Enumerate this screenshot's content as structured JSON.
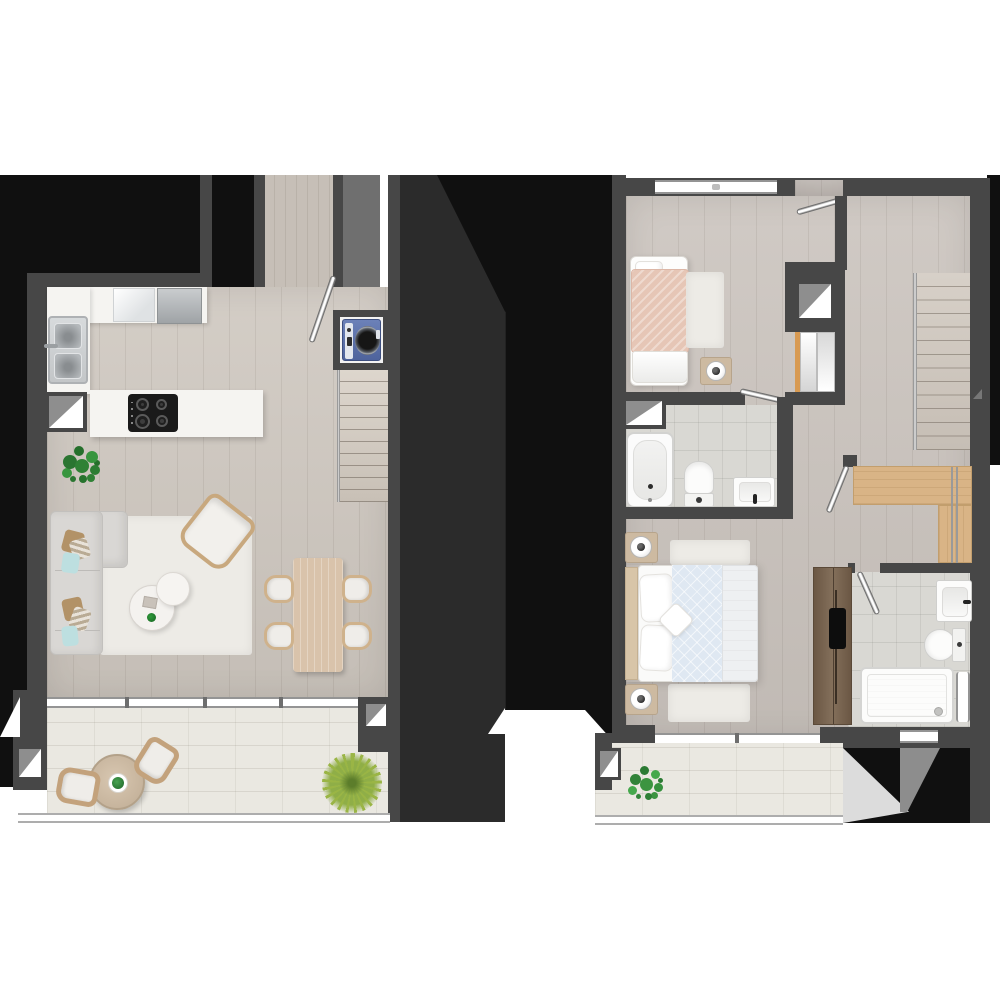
{
  "palette": {
    "bg": "#ffffff",
    "wall": "#474747",
    "black": "#101010",
    "charcoal": "#2b2b2b",
    "midGray": "#6f6f6f",
    "shaftGray": "#8e8e8e",
    "woodA": "#cfc8c0",
    "woodB": "#cbc4be",
    "corridorWood": "#c6bfb7",
    "tile": "#eae8e1",
    "bathTile": "#d9d8d3",
    "counter": "#f5f4f1",
    "cooktop": "#1a1a1a",
    "sofa": "#d9d7d4",
    "pillowTan": "#b29267",
    "pillowTeal": "#bddfe0",
    "rug": "#edebe6",
    "tableWood": "#d9c3ab",
    "chairWood": "#cfb28c",
    "blush": "#e6c6b6",
    "duvet": "#dfe8f2",
    "blanket": "#eef0f2",
    "headboard": "#d8c5a8",
    "nightstand": "#cdbaa1",
    "walkinWood": "#d9b486",
    "tvUnit": "#76614d",
    "washerBlue": "#5d74ad",
    "plantDark": "#2f8135",
    "plantPalm": "#9ab545",
    "plantBalcony": "#3c9440",
    "windowFrame": "#949494",
    "balRail": "#adadad",
    "lightTri": "#dcdcdc",
    "grayStrip": "#8d8d8d"
  },
  "plan": {
    "type": "two-level-apartment-floor-plan",
    "lower_level": {
      "rooms": [
        "entry-corridor",
        "kitchen",
        "living-dining-room",
        "terrace",
        "laundry-closet",
        "staircase"
      ],
      "furniture": [
        "double-sink",
        "kitchen-counter",
        "fridge",
        "kitchen-island",
        "cooktop-4-burners",
        "monstera-plant",
        "corner-sofa",
        "armchair",
        "two-round-coffee-tables",
        "area-rug",
        "dining-table",
        "dining-chairs-x4",
        "washing-machine",
        "terrace-round-table",
        "terrace-chairs-x2",
        "palm-plant"
      ],
      "shafts": 3,
      "doors": [
        "entry-door"
      ],
      "windows": [
        "terrace-sliding-window"
      ]
    },
    "upper_level": {
      "rooms": [
        "bedroom",
        "bathroom",
        "hall-with-staircase",
        "walk-in-closet",
        "master-bedroom",
        "ensuite-bathroom",
        "balcony"
      ],
      "furniture": [
        "single-bed",
        "bedside-table-lamp",
        "sliding-wardrobe",
        "bathtub",
        "toilet",
        "washbasin",
        "double-bed",
        "nightstands-x2-with-lamps",
        "rugs",
        "tv-cabinet",
        "shower-tray",
        "ensuite-toilet",
        "ensuite-basin",
        "balcony-plant",
        "wood-wardrobe-l-shape"
      ],
      "shafts": 3,
      "doors": [
        "bedroom-entry-door",
        "bathroom-door",
        "master-bedroom-door",
        "ensuite-door"
      ],
      "windows": [
        "bedroom-window",
        "master-window",
        "ensuite-window",
        "bath-window"
      ]
    }
  }
}
